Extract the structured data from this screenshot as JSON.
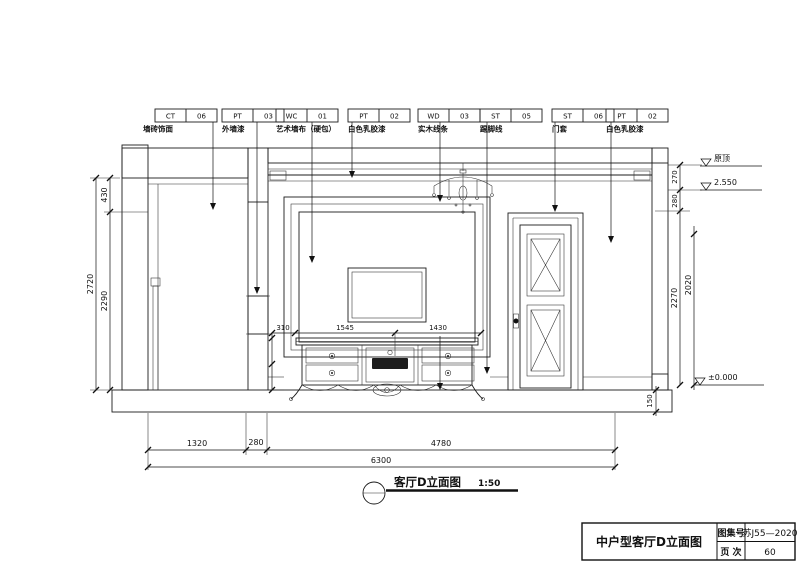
{
  "drawing": {
    "materials": [
      {
        "code": "CT",
        "num": "06",
        "desc": "墙砖饰面"
      },
      {
        "code": "PT",
        "num": "03",
        "desc": "外墙漆"
      },
      {
        "code": "WC",
        "num": "01",
        "desc": "艺术墙布（硬包）"
      },
      {
        "code": "PT",
        "num": "02",
        "desc": "白色乳胶漆"
      },
      {
        "code": "WD",
        "num": "03",
        "desc": "实木线条"
      },
      {
        "code": "ST",
        "num": "05",
        "desc": "踢脚线"
      },
      {
        "code": "ST",
        "num": "06",
        "desc": "门套"
      },
      {
        "code": "PT",
        "num": "02",
        "desc": "白色乳胶漆"
      }
    ],
    "dims": {
      "left_total": "2720",
      "left_top": "430",
      "left_bottom": "2290",
      "right_seg1": "270",
      "right_seg2": "280",
      "right_seg3": "2270",
      "right_door": "2020",
      "slab": "150",
      "bottom_seg1": "1320",
      "bottom_seg2": "280",
      "bottom_seg3": "4780",
      "bottom_total": "6300",
      "cab_seg1": "310",
      "cab_seg2": "1545",
      "cab_seg3": "1430"
    },
    "levels": {
      "roof": "原顶",
      "ceiling": "2.550",
      "floor": "±0.000"
    },
    "caption": {
      "title": "客厅D立面图",
      "scale": "1:50"
    }
  },
  "titleblock": {
    "name": "中户型客厅D立面图",
    "atlas_label": "图集号",
    "atlas_value": "苏J55—2020",
    "page_label": "页 次",
    "page_value": "60"
  }
}
